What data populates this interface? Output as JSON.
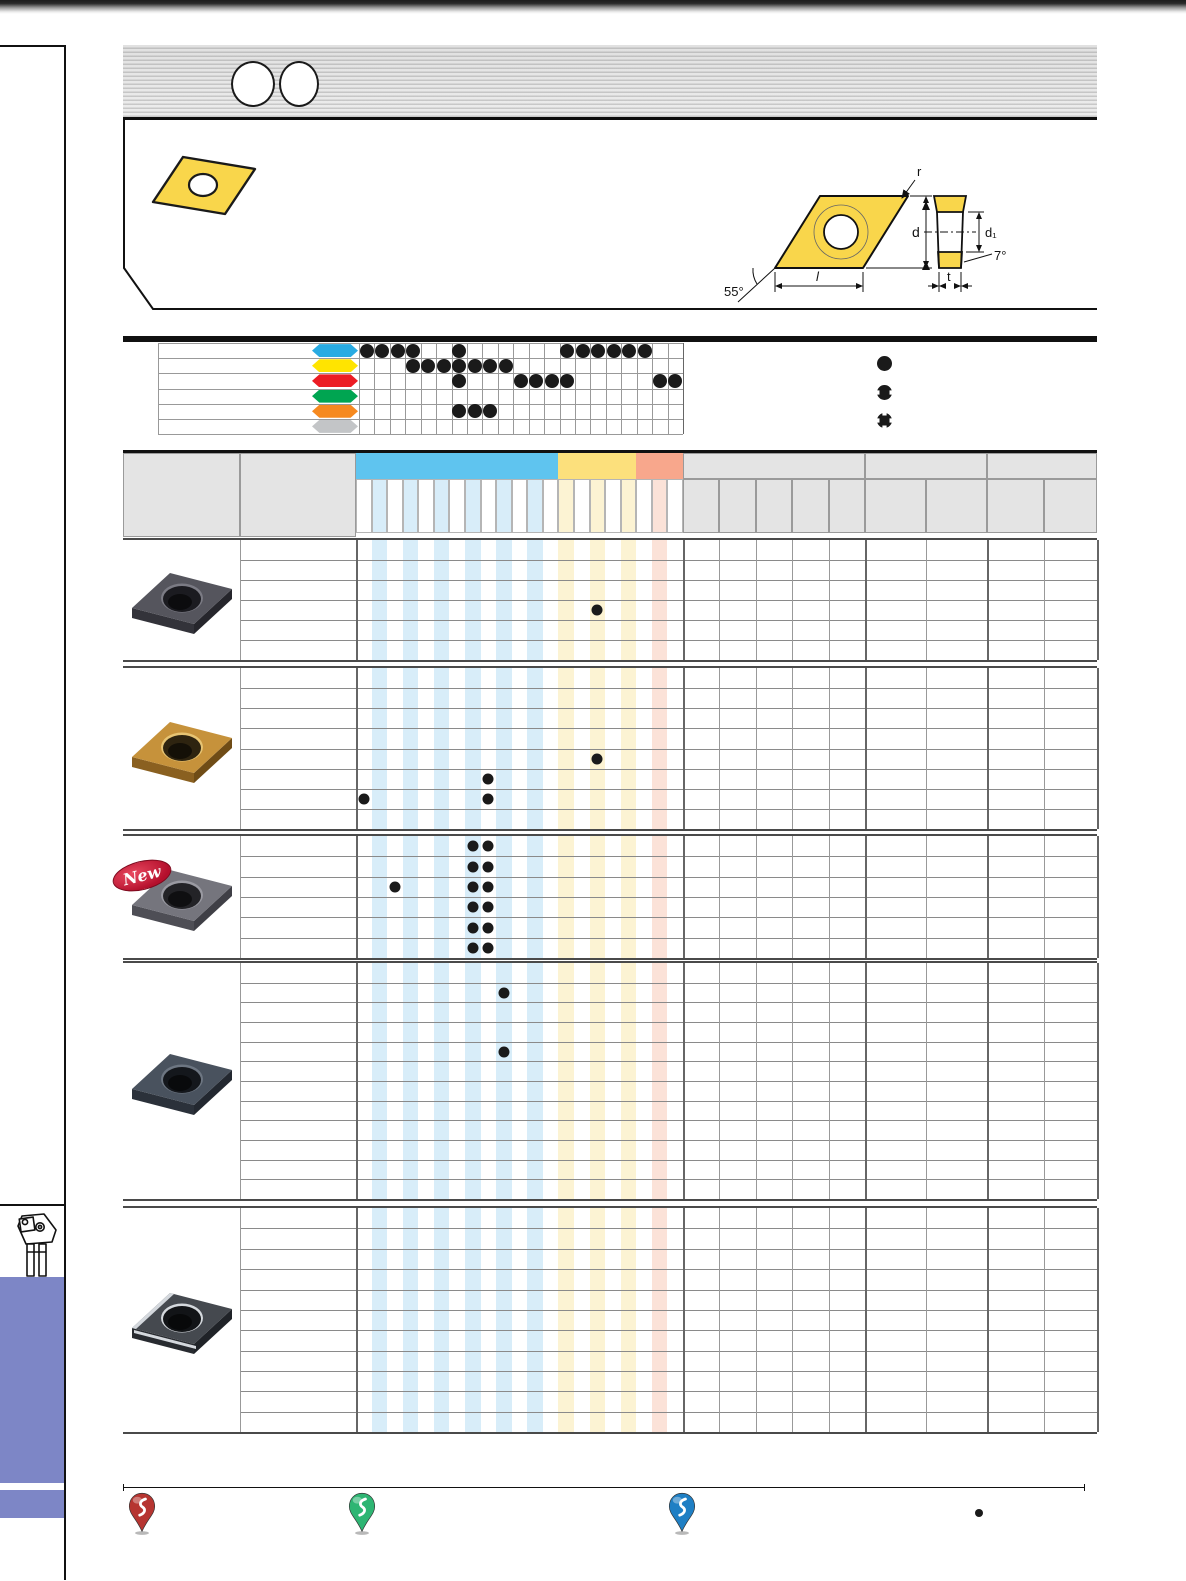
{
  "page_type": "tool-catalog-page",
  "drawing": {
    "labels": {
      "r": "r",
      "d": "d",
      "d1": "d₁",
      "angle7": "7°",
      "angle55": "55°",
      "l": "l",
      "t": "t"
    }
  },
  "new_badge": {
    "label": "New"
  },
  "application_chart": {
    "type": "table",
    "columns": 21,
    "legend": [
      {
        "symbol": "full-circle"
      },
      {
        "symbol": "half-circle"
      },
      {
        "symbol": "quarter-circle"
      }
    ],
    "rows": [
      {
        "name": "row-blue",
        "color": "#29abe2",
        "marks": {
          "1": "full",
          "2": "half",
          "3": "half",
          "4": "quarter",
          "7": "half",
          "14": "full",
          "15": "half",
          "16": "half",
          "17": "full",
          "18": "full",
          "19": "half"
        }
      },
      {
        "name": "row-yellow",
        "color": "#ffe400",
        "marks": {
          "4": "half",
          "5": "half",
          "6": "half",
          "7": "half",
          "8": "full",
          "9": "half",
          "10": "half"
        }
      },
      {
        "name": "row-red",
        "color": "#ec1c24",
        "marks": {
          "7": "half",
          "11": "full",
          "12": "half",
          "13": "quarter",
          "14": "full",
          "20": "full",
          "21": "half"
        }
      },
      {
        "name": "row-green",
        "color": "#00a551",
        "marks": {}
      },
      {
        "name": "row-orange",
        "color": "#f6891f",
        "marks": {
          "7": "half",
          "8": "full",
          "9": "half"
        }
      },
      {
        "name": "row-gray",
        "color": "#c3c5c7",
        "marks": {}
      }
    ]
  },
  "grade_bands": [
    {
      "name": "band-blue",
      "color": "#5fc4ef",
      "tint": "#d8edf9",
      "cols": 13,
      "tinted": [
        2,
        4,
        6,
        8,
        10,
        12
      ]
    },
    {
      "name": "band-yellow",
      "color": "#fce07c",
      "tint": "#fcf3d3",
      "cols": 5,
      "tinted": [
        1,
        3,
        5
      ]
    },
    {
      "name": "band-red",
      "color": "#f8a78c",
      "tint": "#fbe2d8",
      "cols": 3,
      "tinted": [
        2
      ]
    }
  ],
  "dim_sections": [
    {
      "name": "dimensions",
      "subcols": 5
    },
    {
      "name": "section-b",
      "subcols": 2
    },
    {
      "name": "section-c",
      "subcols": 2
    }
  ],
  "products": [
    {
      "id": "group-1",
      "rows": 6,
      "new": false,
      "style": "dark-gray",
      "dots": [
        [
          4,
          16
        ]
      ]
    },
    {
      "id": "group-2",
      "rows": 8,
      "new": false,
      "style": "gold",
      "dots": [
        [
          5,
          16
        ],
        [
          6,
          9
        ],
        [
          7,
          1
        ],
        [
          7,
          9
        ]
      ]
    },
    {
      "id": "group-3",
      "rows": 6,
      "new": true,
      "style": "gray",
      "dots": [
        [
          1,
          8
        ],
        [
          1,
          9
        ],
        [
          2,
          8
        ],
        [
          2,
          9
        ],
        [
          3,
          3
        ],
        [
          3,
          8
        ],
        [
          3,
          9
        ],
        [
          4,
          8
        ],
        [
          4,
          9
        ],
        [
          5,
          8
        ],
        [
          5,
          9
        ],
        [
          6,
          8
        ],
        [
          6,
          9
        ]
      ]
    },
    {
      "id": "group-4",
      "rows": 12,
      "new": false,
      "style": "blue-gray",
      "dots": [
        [
          2,
          10
        ],
        [
          5,
          10
        ]
      ]
    },
    {
      "id": "group-5",
      "rows": 11,
      "new": false,
      "style": "dark-polished",
      "dots": []
    }
  ],
  "insert_styles": {
    "dark-gray": {
      "top": "#55555d",
      "side": "#33333a",
      "side2": "#26262c",
      "hole": "#1b1b20",
      "rim": "#7b7b84",
      "edge": false
    },
    "gold": {
      "top": "#c6923b",
      "side": "#8a6020",
      "side2": "#6f4c16",
      "hole": "#2e2410",
      "rim": "#e7c473",
      "edge": false
    },
    "gray": {
      "top": "#75757d",
      "side": "#4e4e55",
      "side2": "#3f3f46",
      "hole": "#232327",
      "rim": "#9a9aa2",
      "edge": false
    },
    "blue-gray": {
      "top": "#49525e",
      "side": "#2b313a",
      "side2": "#232830",
      "hole": "#14171c",
      "rim": "#6d7682",
      "edge": false
    },
    "dark-polished": {
      "top": "#45494f",
      "side": "#282b30",
      "side2": "#202328",
      "hole": "#121417",
      "rim": "#d4d8dd",
      "edge": true
    }
  },
  "sidebar": {
    "accent_color": "#7d86c6",
    "tool_icon": "turning-toolholder-icon"
  },
  "footer": {
    "pins": [
      {
        "name": "chipbreaker-pin-red",
        "color": "#b63531"
      },
      {
        "name": "chipbreaker-pin-green",
        "color": "#2eb573"
      },
      {
        "name": "chipbreaker-pin-blue",
        "color": "#1f7fc4"
      }
    ],
    "note_bullet": "•"
  },
  "colors": {
    "insert_sketch_yellow": "#f9d64b",
    "table_line": "#999999",
    "mark_color": "#1a1a1a"
  }
}
